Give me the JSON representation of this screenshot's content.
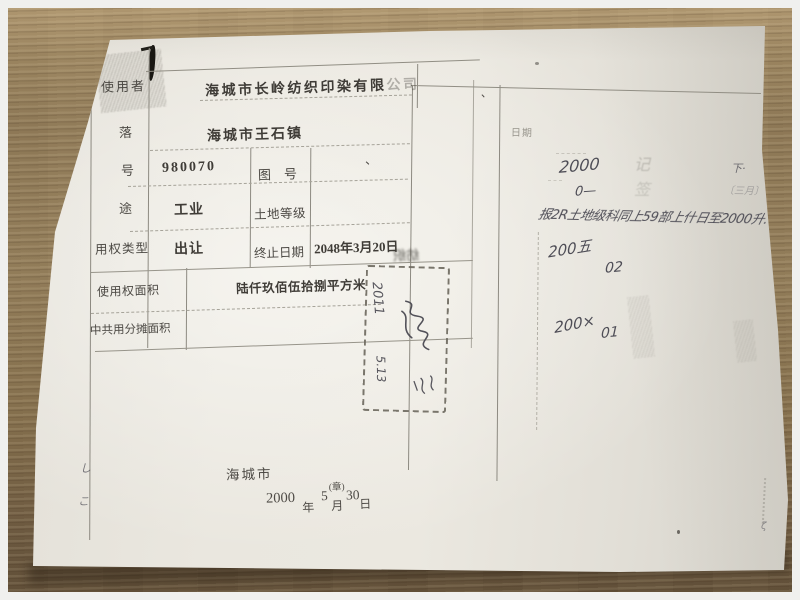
{
  "doc": {
    "table": {
      "rows": [
        {
          "label": "使用者",
          "value": "海城市长岭纺织印染有限",
          "value_faded": "公司"
        },
        {
          "label": "落",
          "value": "海城市王石镇"
        },
        {
          "label": "号",
          "value": "980070",
          "label2": "图　号",
          "value2": "、"
        },
        {
          "label": "途",
          "value": "工业",
          "label2": "土地等级",
          "value2": ""
        },
        {
          "label": "用权类型",
          "value": "出让",
          "label2": "终止日期",
          "value2": "2048年3月20日"
        },
        {
          "label": "使用权面积",
          "value": "陆仟玖佰伍拾捌平方米"
        },
        {
          "label": "中共用分摊面积",
          "value": ""
        }
      ]
    },
    "issuer": {
      "city": "海城市",
      "year": "2000",
      "year_unit": "年",
      "month": "5",
      "seal_note": "(章)",
      "month_unit": "月",
      "day": "30",
      "day_unit": "日"
    },
    "stamp": {
      "line1": "2011",
      "line2": "5.13"
    },
    "right_column": {
      "header": "日期",
      "hw_2000": "2000",
      "hw_0": "0—",
      "hw_down": "下·",
      "faint_month": "〔三月〕",
      "hw_note": "报2R土地级科同上59部上什日至2000升.",
      "hw_2005": "200五",
      "hw_02": "02",
      "hw_200x": "200×",
      "hw_01": "01",
      "faint_stamp_a": "记",
      "faint_stamp_b": "签"
    },
    "marks": {
      "left1": "し",
      "left2": "こ",
      "tick1": "、",
      "tick2": "、",
      "edge": "ζ",
      "mirror": "纺织"
    }
  },
  "colors": {
    "paper": "#e9e6de",
    "wood": "#8f7a58",
    "line": "#8d8a81",
    "ink": "#4c4944",
    "pencil": "#4e4d56"
  }
}
